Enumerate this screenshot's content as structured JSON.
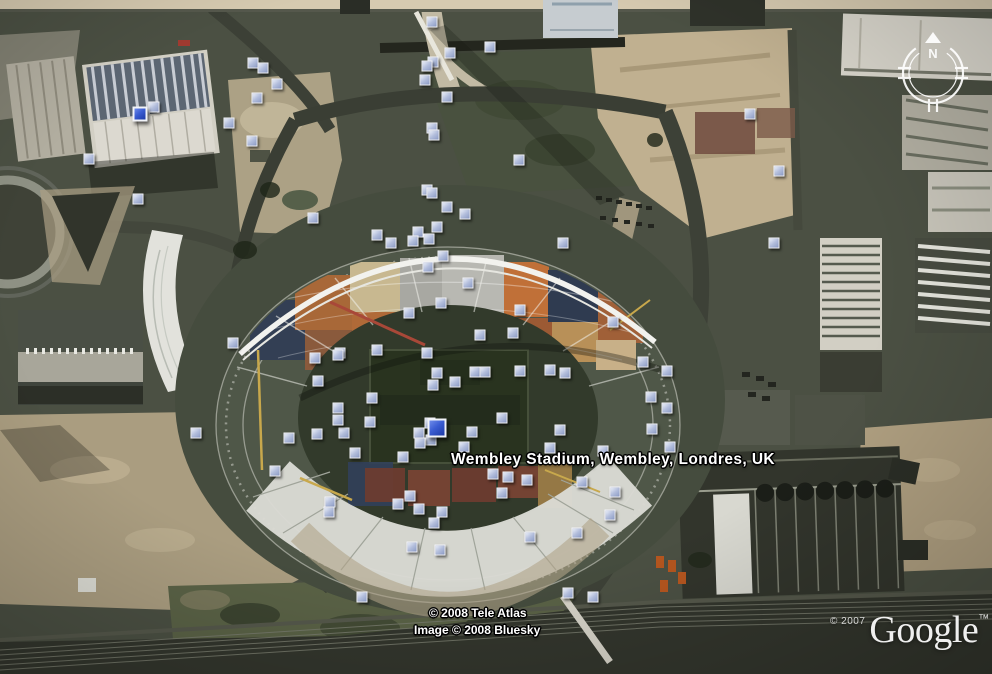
{
  "app": {
    "name": "Google Earth satellite view"
  },
  "map_label": {
    "text": "Wembley Stadium, Wembley, Londres, UK"
  },
  "attribution": {
    "line1": "© 2008 Tele Atlas",
    "line2": "Image © 2008 Bluesky"
  },
  "branding": {
    "copyright": "© 2007",
    "logo": "Google",
    "trademark": "™"
  },
  "compass": {
    "north_label": "N"
  },
  "colors": {
    "marker_fill": "#b3bedc",
    "marker_border": "#f5f6fa",
    "marker_featured_fill": "#3a5cd2",
    "label_text": "#ffffff",
    "label_outline": "#000000",
    "terrain_base": "#4b5043",
    "terrain_sand": "#b8ab8c",
    "stadium_roof": "#dadad4",
    "arch_white": "#f2f2ee"
  },
  "markers": {
    "small": [
      [
        253,
        63
      ],
      [
        263,
        68
      ],
      [
        277,
        84
      ],
      [
        257,
        98
      ],
      [
        154,
        107
      ],
      [
        229,
        123
      ],
      [
        252,
        141
      ],
      [
        89,
        159
      ],
      [
        138,
        199
      ],
      [
        313,
        218
      ],
      [
        432,
        22
      ],
      [
        450,
        53
      ],
      [
        490,
        47
      ],
      [
        433,
        62
      ],
      [
        427,
        66
      ],
      [
        425,
        80
      ],
      [
        447,
        97
      ],
      [
        432,
        128
      ],
      [
        434,
        135
      ],
      [
        519,
        160
      ],
      [
        427,
        190
      ],
      [
        432,
        193
      ],
      [
        447,
        207
      ],
      [
        465,
        214
      ],
      [
        377,
        235
      ],
      [
        437,
        227
      ],
      [
        418,
        232
      ],
      [
        413,
        241
      ],
      [
        429,
        239
      ],
      [
        391,
        243
      ],
      [
        563,
        243
      ],
      [
        443,
        256
      ],
      [
        428,
        267
      ],
      [
        468,
        283
      ],
      [
        441,
        303
      ],
      [
        409,
        313
      ],
      [
        520,
        310
      ],
      [
        613,
        322
      ],
      [
        750,
        114
      ],
      [
        779,
        171
      ],
      [
        774,
        243
      ],
      [
        233,
        343
      ],
      [
        315,
        358
      ],
      [
        340,
        353
      ],
      [
        318,
        381
      ],
      [
        196,
        433
      ],
      [
        289,
        438
      ],
      [
        275,
        471
      ],
      [
        338,
        355
      ],
      [
        377,
        350
      ],
      [
        427,
        353
      ],
      [
        480,
        335
      ],
      [
        513,
        333
      ],
      [
        550,
        370
      ],
      [
        565,
        373
      ],
      [
        437,
        373
      ],
      [
        455,
        382
      ],
      [
        433,
        385
      ],
      [
        475,
        372
      ],
      [
        485,
        372
      ],
      [
        520,
        371
      ],
      [
        372,
        398
      ],
      [
        338,
        408
      ],
      [
        370,
        422
      ],
      [
        430,
        423
      ],
      [
        419,
        433
      ],
      [
        431,
        440
      ],
      [
        472,
        432
      ],
      [
        502,
        418
      ],
      [
        464,
        447
      ],
      [
        420,
        443
      ],
      [
        344,
        433
      ],
      [
        355,
        453
      ],
      [
        403,
        457
      ],
      [
        338,
        420
      ],
      [
        317,
        434
      ],
      [
        330,
        502
      ],
      [
        329,
        512
      ],
      [
        493,
        474
      ],
      [
        508,
        477
      ],
      [
        527,
        480
      ],
      [
        502,
        493
      ],
      [
        410,
        496
      ],
      [
        398,
        504
      ],
      [
        419,
        509
      ],
      [
        442,
        512
      ],
      [
        434,
        523
      ],
      [
        412,
        547
      ],
      [
        440,
        550
      ],
      [
        530,
        537
      ],
      [
        550,
        448
      ],
      [
        560,
        430
      ],
      [
        582,
        482
      ],
      [
        615,
        492
      ],
      [
        610,
        515
      ],
      [
        577,
        533
      ],
      [
        568,
        593
      ],
      [
        593,
        597
      ],
      [
        362,
        597
      ],
      [
        643,
        362
      ],
      [
        667,
        371
      ],
      [
        651,
        397
      ],
      [
        667,
        408
      ],
      [
        652,
        429
      ],
      [
        670,
        447
      ],
      [
        603,
        451
      ]
    ],
    "featured": [
      {
        "x": 140,
        "y": 114,
        "size": 15
      },
      {
        "x": 437,
        "y": 428,
        "size": 19
      }
    ]
  }
}
